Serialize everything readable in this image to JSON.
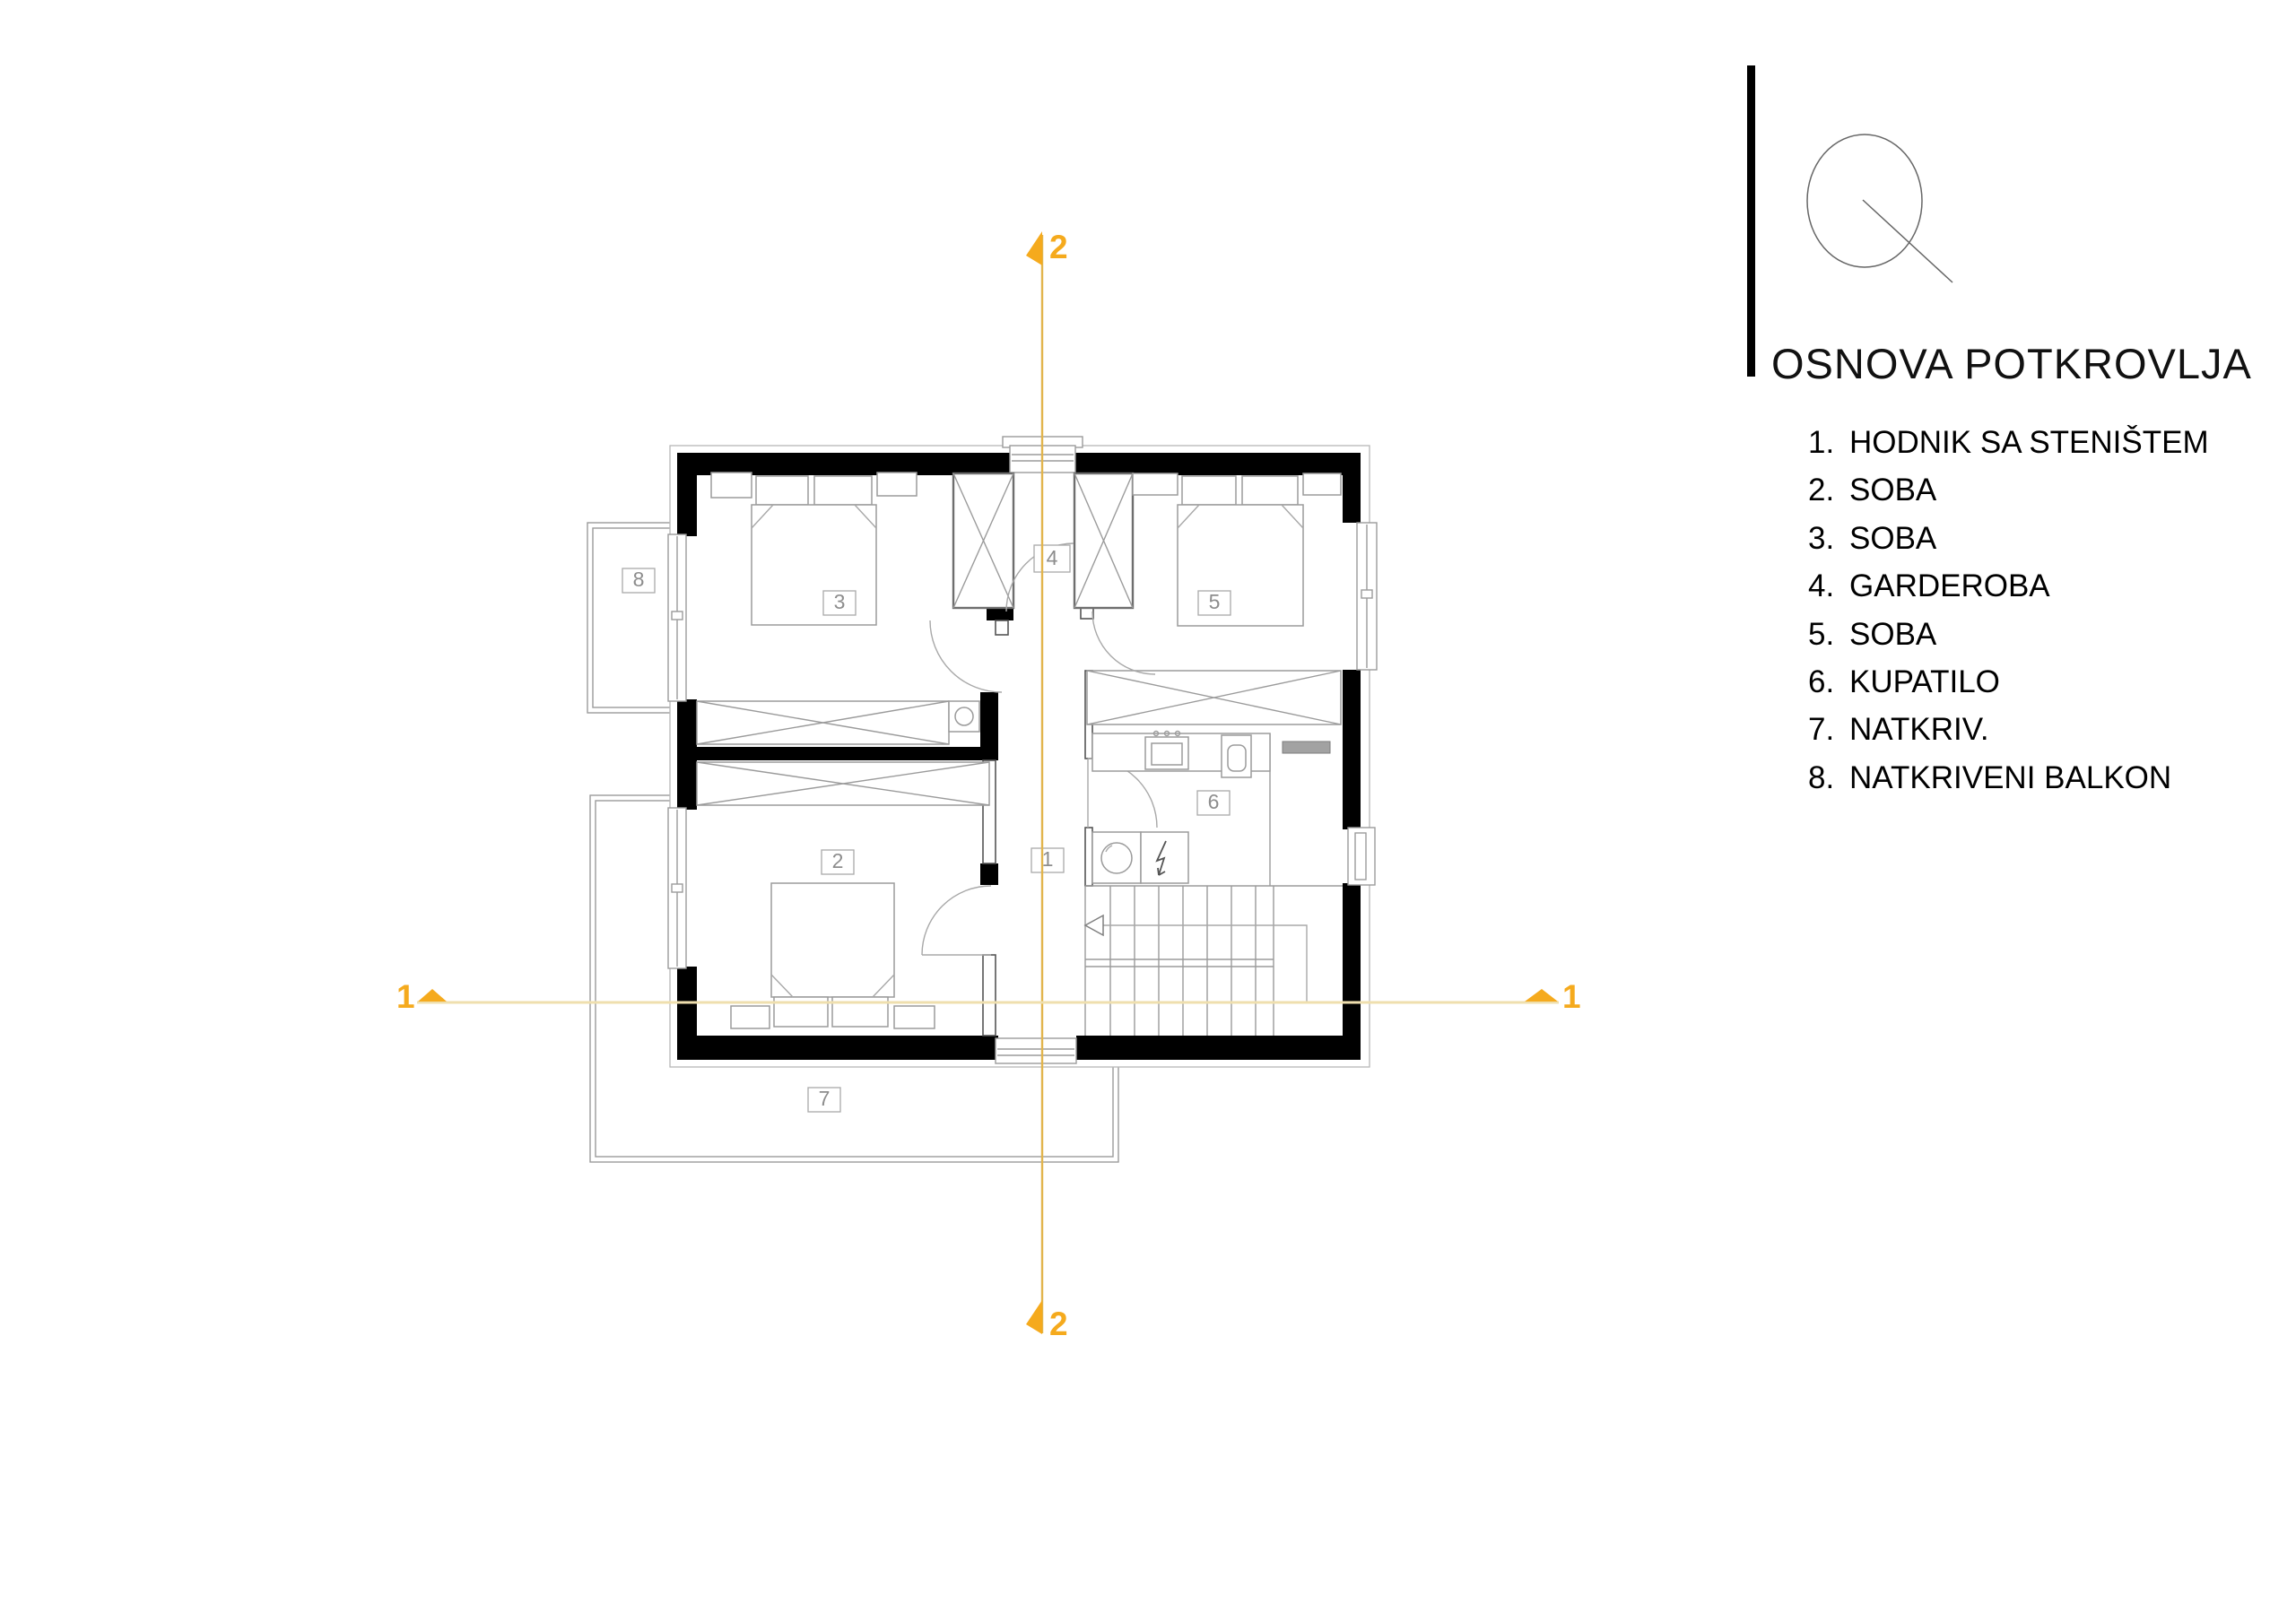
{
  "title": "OSNOVA POTKROVLJA",
  "legend": {
    "items": [
      {
        "num": "1.",
        "label": "HODNIK SA STENIŠTEM"
      },
      {
        "num": "2.",
        "label": "SOBA"
      },
      {
        "num": "3.",
        "label": "SOBA"
      },
      {
        "num": "4.",
        "label": "GARDEROBA"
      },
      {
        "num": "5.",
        "label": "SOBA"
      },
      {
        "num": "6.",
        "label": "KUPATILO"
      },
      {
        "num": "7.",
        "label": "NATKRIV."
      },
      {
        "num": "8.",
        "label": "NATKRIVENI BALKON"
      }
    ]
  },
  "plan": {
    "room_labels": {
      "hallway": "1",
      "bedroom2": "2",
      "bedroom3": "3",
      "wardrobe4": "4",
      "bedroom5": "5",
      "bathroom6": "6",
      "terrace7": "7",
      "balcony8": "8"
    },
    "sections": {
      "vertical_top": "2",
      "vertical_bottom": "2",
      "horizontal_left": "1",
      "horizontal_right": "1"
    }
  },
  "colors": {
    "wall": "#000000",
    "thin_line": "#9b9b9b",
    "section_marker": "#f5aa1d",
    "section_line_vertical": "#e2b54d",
    "section_line_horizontal": "#efdfae"
  }
}
